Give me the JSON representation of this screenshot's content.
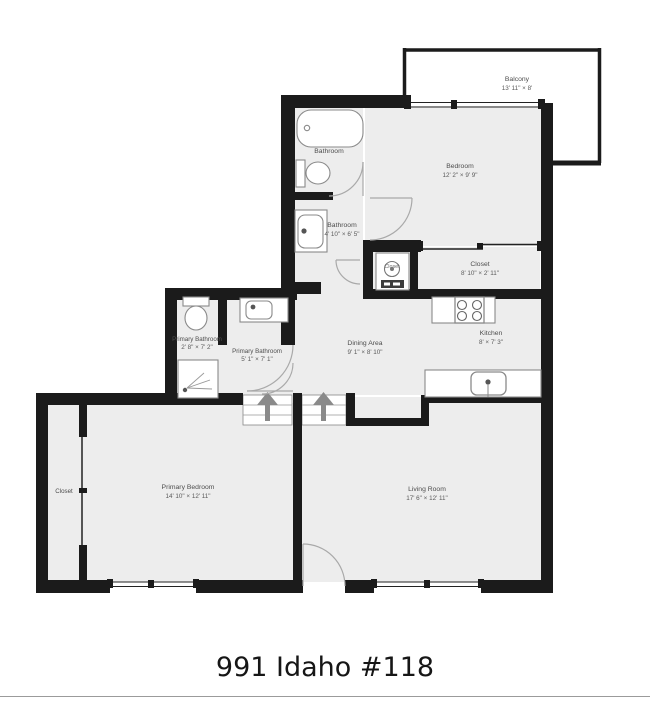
{
  "title": "991 Idaho #118",
  "floorplan": {
    "wall_color": "#1b1b1b",
    "room_fill": "#ededed",
    "rooms": [
      {
        "name": "Balcony",
        "dims": "13' 11\" × 8'"
      },
      {
        "name": "Bedroom",
        "dims": "12' 2\" × 9' 9\""
      },
      {
        "name": "Bathroom",
        "dims": ""
      },
      {
        "name": "Bathroom",
        "dims": "4' 10\" × 6' 5\""
      },
      {
        "name": "Closet",
        "dims": "8' 10\" × 2' 11\""
      },
      {
        "name": "Closet",
        "dims": ""
      },
      {
        "name": "Kitchen",
        "dims": "8' × 7' 3\""
      },
      {
        "name": "Dining Area",
        "dims": "9' 1\" × 8' 10\""
      },
      {
        "name": "Primary Bathroom",
        "dims": "2' 8\" × 7' 2\""
      },
      {
        "name": "Primary Bathroom",
        "dims": "5' 1\" × 7' 1\""
      },
      {
        "name": "Primary Bedroom",
        "dims": "14' 10\" × 12' 11\""
      },
      {
        "name": "Closet",
        "dims": ""
      },
      {
        "name": "Living Room",
        "dims": "17' 6\" × 12' 11\""
      }
    ]
  }
}
